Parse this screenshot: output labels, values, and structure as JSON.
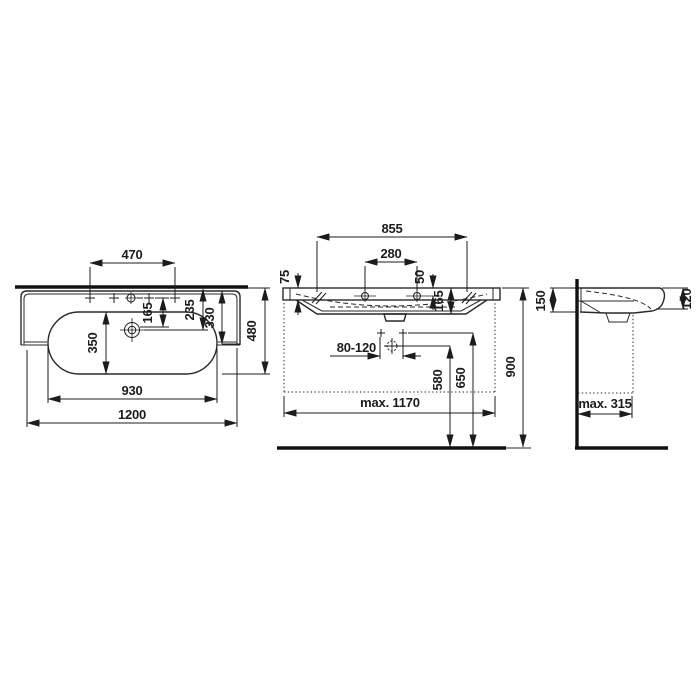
{
  "colors": {
    "line": "#1c1c1c",
    "background": "#ffffff"
  },
  "plan_view": {
    "tap_spacing": "470",
    "tap_to_drain": "165",
    "edge_to_drain": "235",
    "rim_depth": "330",
    "overall_depth": "480",
    "bowl_depth": "350",
    "bowl_width": "930",
    "overall_width": "1200"
  },
  "front_view": {
    "fixing_width": "855",
    "tap_hole_width": "280",
    "rim_height": "75",
    "hole_offset": "50",
    "basin_inner_height": "165",
    "drain_range": "80-120",
    "drain_height": "580",
    "supply_height": "650",
    "rim_top_height": "900",
    "max_clearance_width": "max. 1170"
  },
  "side_view": {
    "back_height": "150",
    "front_height": "120",
    "max_projection": "max. 315"
  }
}
